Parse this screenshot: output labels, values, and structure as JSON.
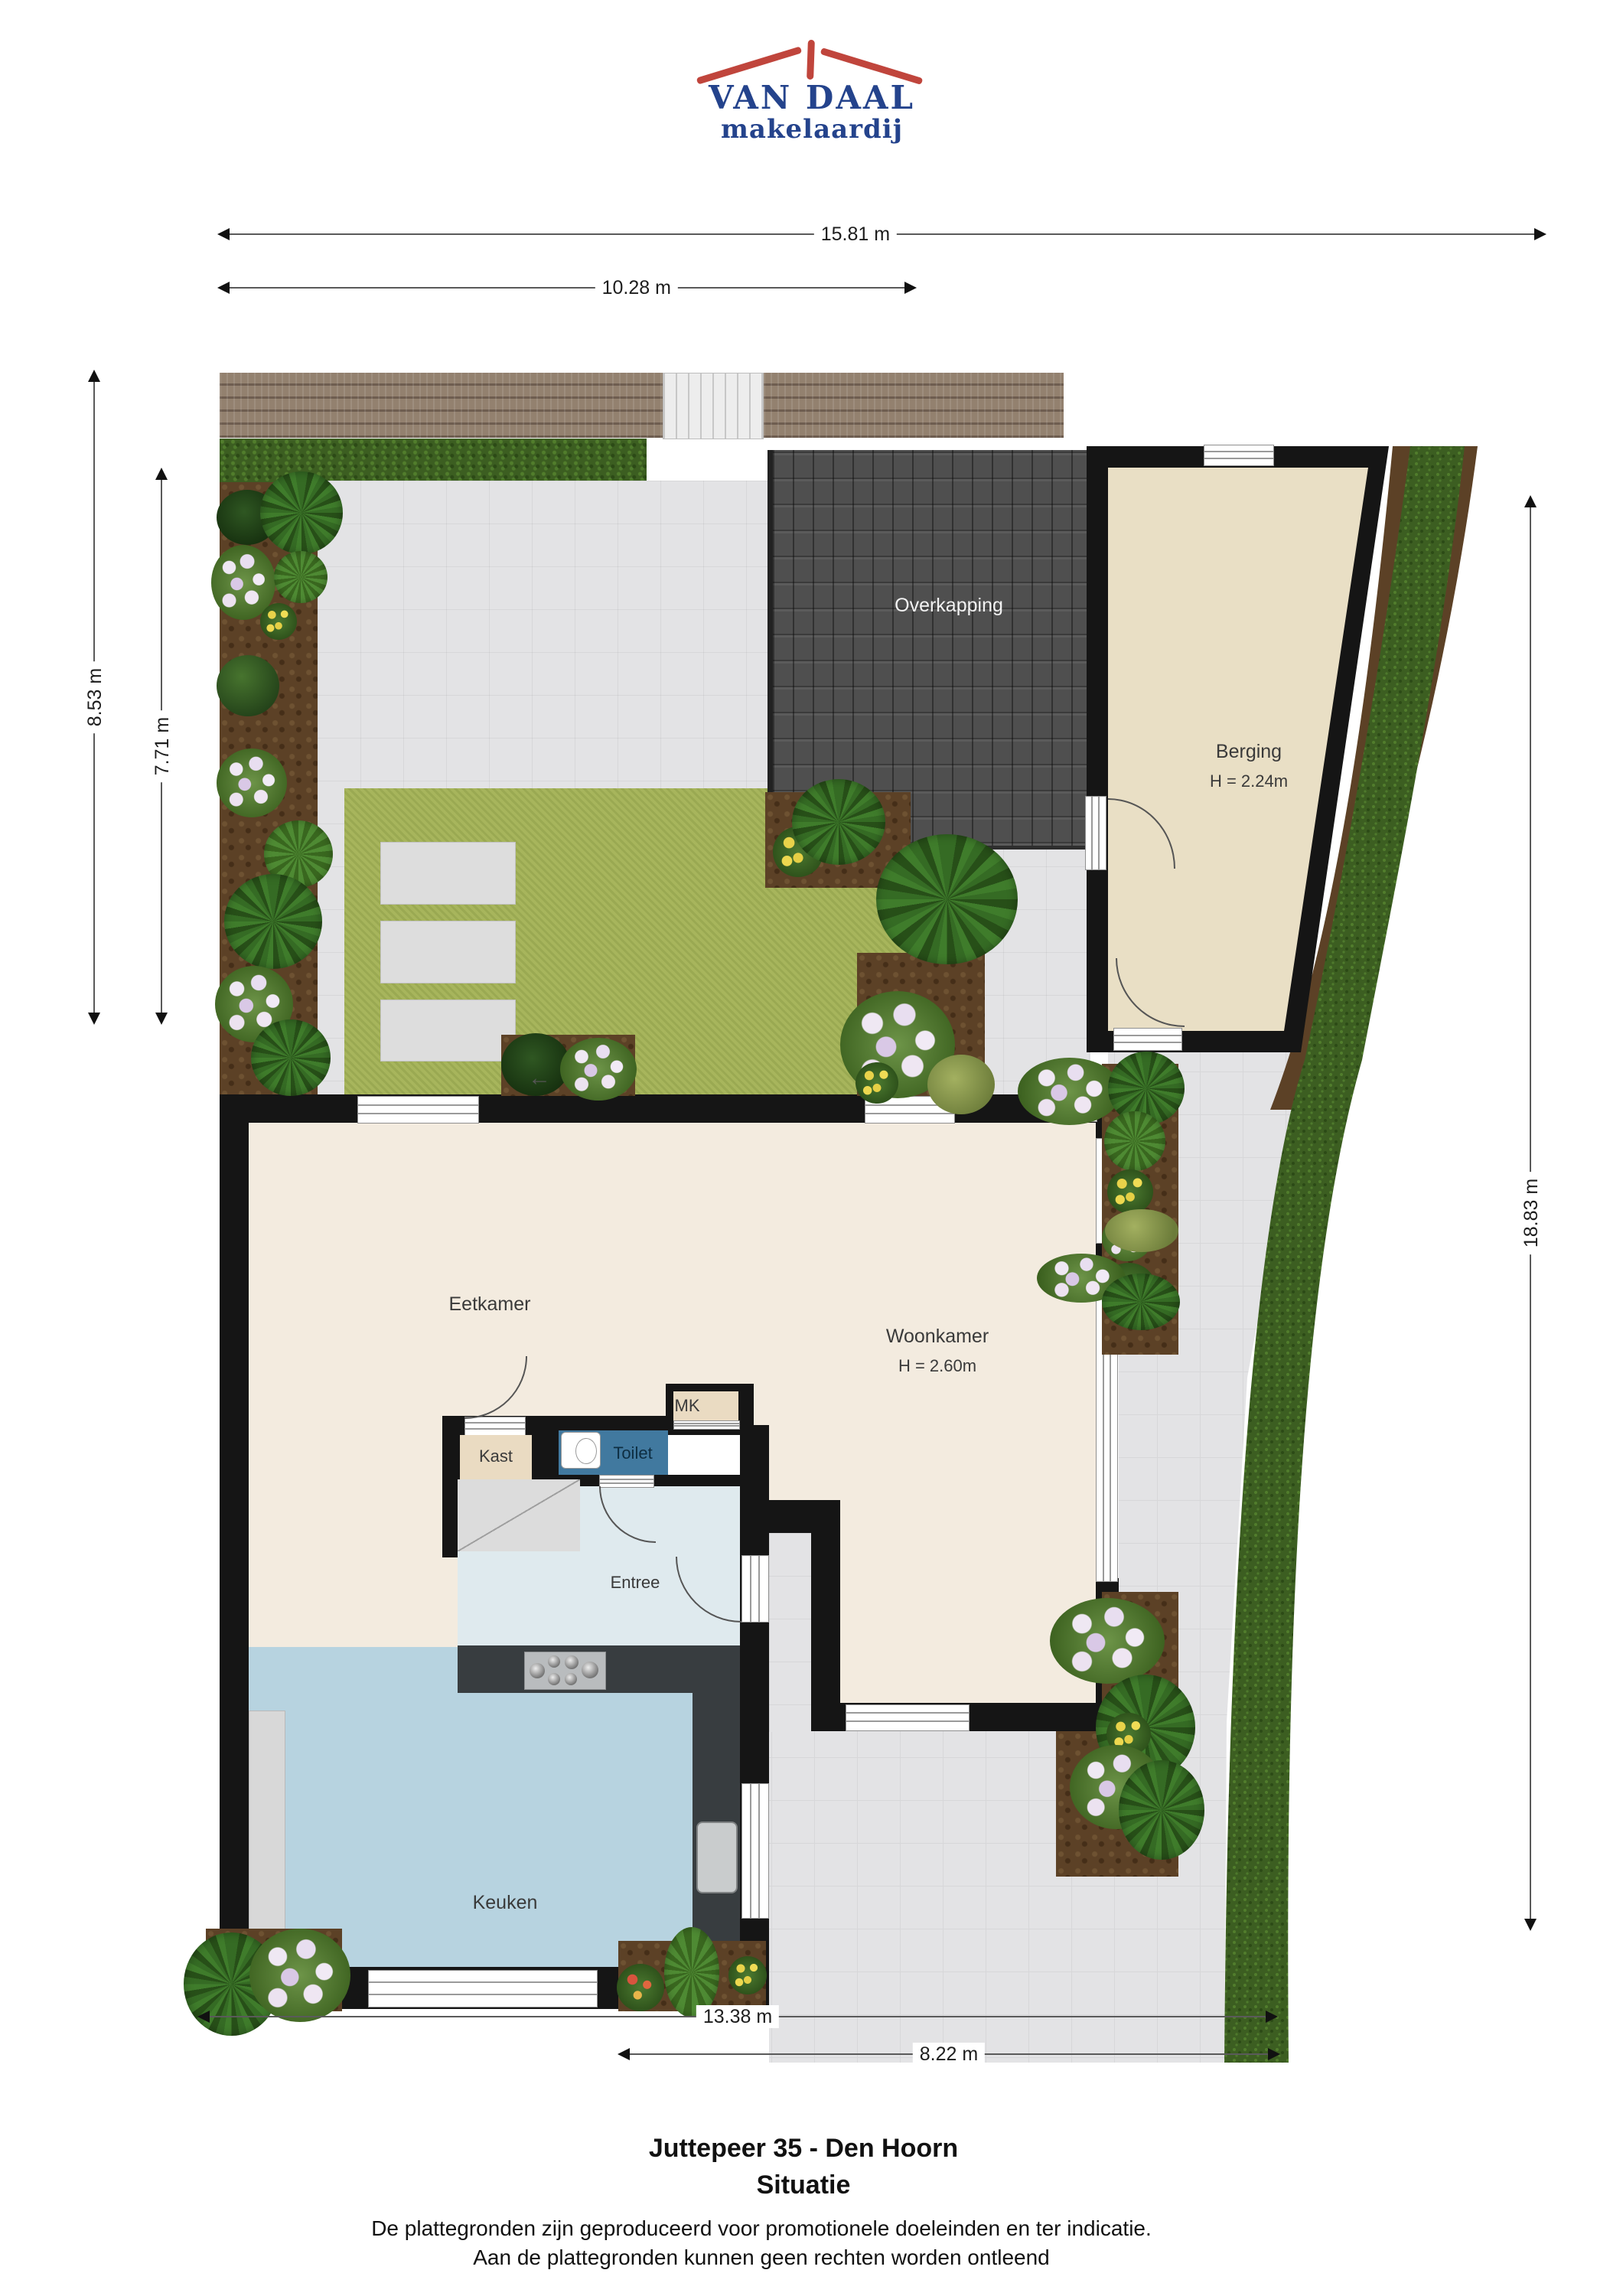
{
  "logo": {
    "name": "VAN DAAL",
    "tagline": "makelaardij"
  },
  "dimensions": {
    "top_total": "15.81 m",
    "top_left": "10.28 m",
    "left_outer": "8.53 m",
    "left_inner": "7.71 m",
    "right_side": "18.83 m",
    "bottom_total": "13.38 m",
    "bottom_right": "8.22 m"
  },
  "rooms": {
    "overkapping": "Overkapping",
    "berging": "Berging",
    "berging_height": "H = 2.24m",
    "eetkamer": "Eetkamer",
    "woonkamer": "Woonkamer",
    "woonkamer_height": "H = 2.60m",
    "kast": "Kast",
    "toilet": "Toilet",
    "mk": "MK",
    "entree": "Entree",
    "keuken": "Keuken"
  },
  "icons": {
    "garden_entrance_arrow": "←"
  },
  "footer": {
    "title": "Juttepeer 35 - Den Hoorn",
    "subtitle": "Situatie",
    "disclaimer1": "De plattegronden zijn geproduceerd voor promotionele doeleinden en ter indicatie.",
    "disclaimer2": "Aan de plattegronden kunnen geen rechten worden ontleend"
  },
  "colors": {
    "logo_red": "#c0453c",
    "logo_blue": "#24438c",
    "wall": "#151515",
    "floor_living": "#f3ebdf",
    "floor_kitchen": "#b7d3e0",
    "floor_entry": "#dfeaee",
    "floor_toilet": "#41799f",
    "floor_closet": "#eadbc2",
    "floor_storage": "#e9dfc5",
    "lawn": "#a7b55c",
    "hedge": "#3c5e21",
    "paving": "#e3e3e5",
    "soil": "#5c4126",
    "deck": "#93816f",
    "roof_tiles": "#4f4f4f"
  }
}
